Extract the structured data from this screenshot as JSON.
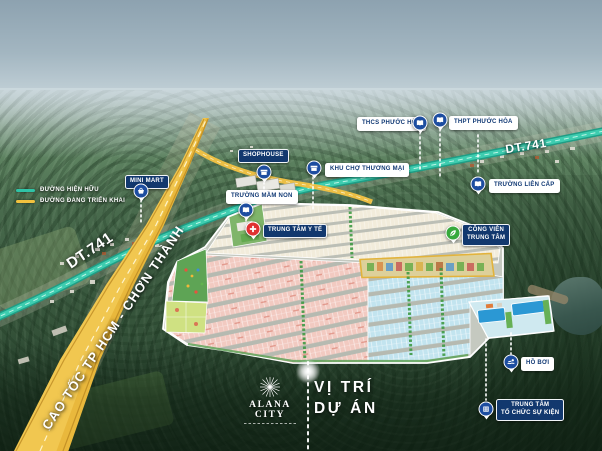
{
  "legend": {
    "items": [
      {
        "label": "ĐƯỜNG HIỆN HỮU",
        "color": "#2fc4a7",
        "meaning": "existing-road"
      },
      {
        "label": "ĐƯỜNG ĐANG TRIỂN KHAI",
        "color": "#f2c23e",
        "meaning": "road-under-development"
      }
    ]
  },
  "roads": {
    "dt741": "DT.741",
    "expressway": "CAO TỐC TP HCM - CHƠN THÀNH"
  },
  "markers": [
    {
      "id": "mini-mart",
      "label": "MINI MART",
      "badge": "navy",
      "pin_color": "#1d4da0",
      "icon": "shop-icon"
    },
    {
      "id": "shophouse",
      "label": "SHOPHOUSE",
      "badge": "navy",
      "pin_color": "#1d4da0",
      "icon": "shop-icon"
    },
    {
      "id": "khu-cho-thuong-mai",
      "label": "KHU CHỢ THƯƠNG MẠI",
      "badge": "white",
      "pin_color": "#1d4da0",
      "icon": "shop-icon"
    },
    {
      "id": "truong-mam-non",
      "label": "TRƯỜNG MẦM NON",
      "badge": "white",
      "pin_color": "#1d4da0",
      "icon": "school-icon"
    },
    {
      "id": "trung-tam-y-te",
      "label": "TRUNG TÂM Y TẾ",
      "badge": "navy",
      "pin_color": "#e03131",
      "icon": "medical-cross-icon"
    },
    {
      "id": "thcs-phuoc-hoa",
      "label": "THCS PHƯỚC HÒA",
      "badge": "white",
      "pin_color": "#1d4da0",
      "icon": "school-icon"
    },
    {
      "id": "thpt-phuoc-hoa",
      "label": "THPT PHƯỚC HÒA",
      "badge": "white",
      "pin_color": "#1d4da0",
      "icon": "school-icon"
    },
    {
      "id": "truong-lien-cap",
      "label": "TRƯỜNG LIÊN CẤP",
      "badge": "white",
      "pin_color": "#1d4da0",
      "icon": "school-icon"
    },
    {
      "id": "cong-vien-trung-tam",
      "label": "CÔNG VIÊN\nTRUNG TÂM",
      "badge": "navy",
      "pin_color": "#37a93c",
      "icon": "leaf-icon"
    },
    {
      "id": "ho-boi",
      "label": "HỒ BƠI",
      "badge": "white",
      "pin_color": "#1d4da0",
      "icon": "swimmer-icon"
    },
    {
      "id": "trung-tam-to-chuc-su-kien",
      "label": "TRUNG TÂM\nTỔ CHỨC SỰ KIỆN",
      "badge": "navy",
      "pin_color": "#1d4da0",
      "icon": "event-building-icon"
    }
  ],
  "project": {
    "brand": "ALANA CITY",
    "location_label": "VỊ TRÍ\nDỰ ÁN"
  },
  "colors": {
    "badge_navy": "#12386e",
    "pin_blue": "#1d4da0",
    "pin_red": "#e03131",
    "pin_green": "#37a93c",
    "road_existing_teal": "#2fc4a7",
    "road_developing_yellow": "#f2c23e",
    "lots_pink": "#f2cac1",
    "lots_blue": "#c2e4ef",
    "lots_cream": "#f2ecdb"
  }
}
